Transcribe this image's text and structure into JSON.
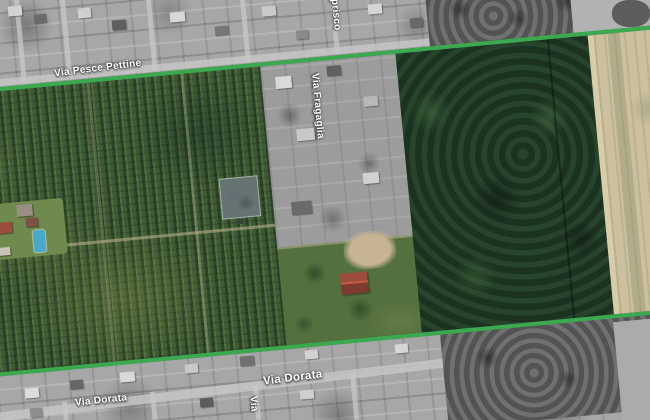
{
  "map": {
    "view": "aerial-satellite-with-parcel-overlay",
    "labels": {
      "via_pesce_pettine": "Via Pesce Pettine",
      "via_caprisco_partial": "aprisco",
      "via_fragaglia": "Via Fragaglia",
      "via_dorata_left": "Via Dorata",
      "via_dorata_right": "Via Dorata",
      "via_partial_bottom": "Via"
    },
    "colors": {
      "boundary_line_green": "#3ba94f",
      "orchard_green": "#45603a",
      "woodland_dark_green": "#223b28",
      "scrub_field_tan": "#cdc09e",
      "grass_green": "#53703e",
      "pond_grey_green": "#657472",
      "pool_blue": "#4aa9cb",
      "roof_red": "#9e4c3b",
      "greyscale_base": "#a7a7a7",
      "label_text": "#ffffff"
    }
  }
}
